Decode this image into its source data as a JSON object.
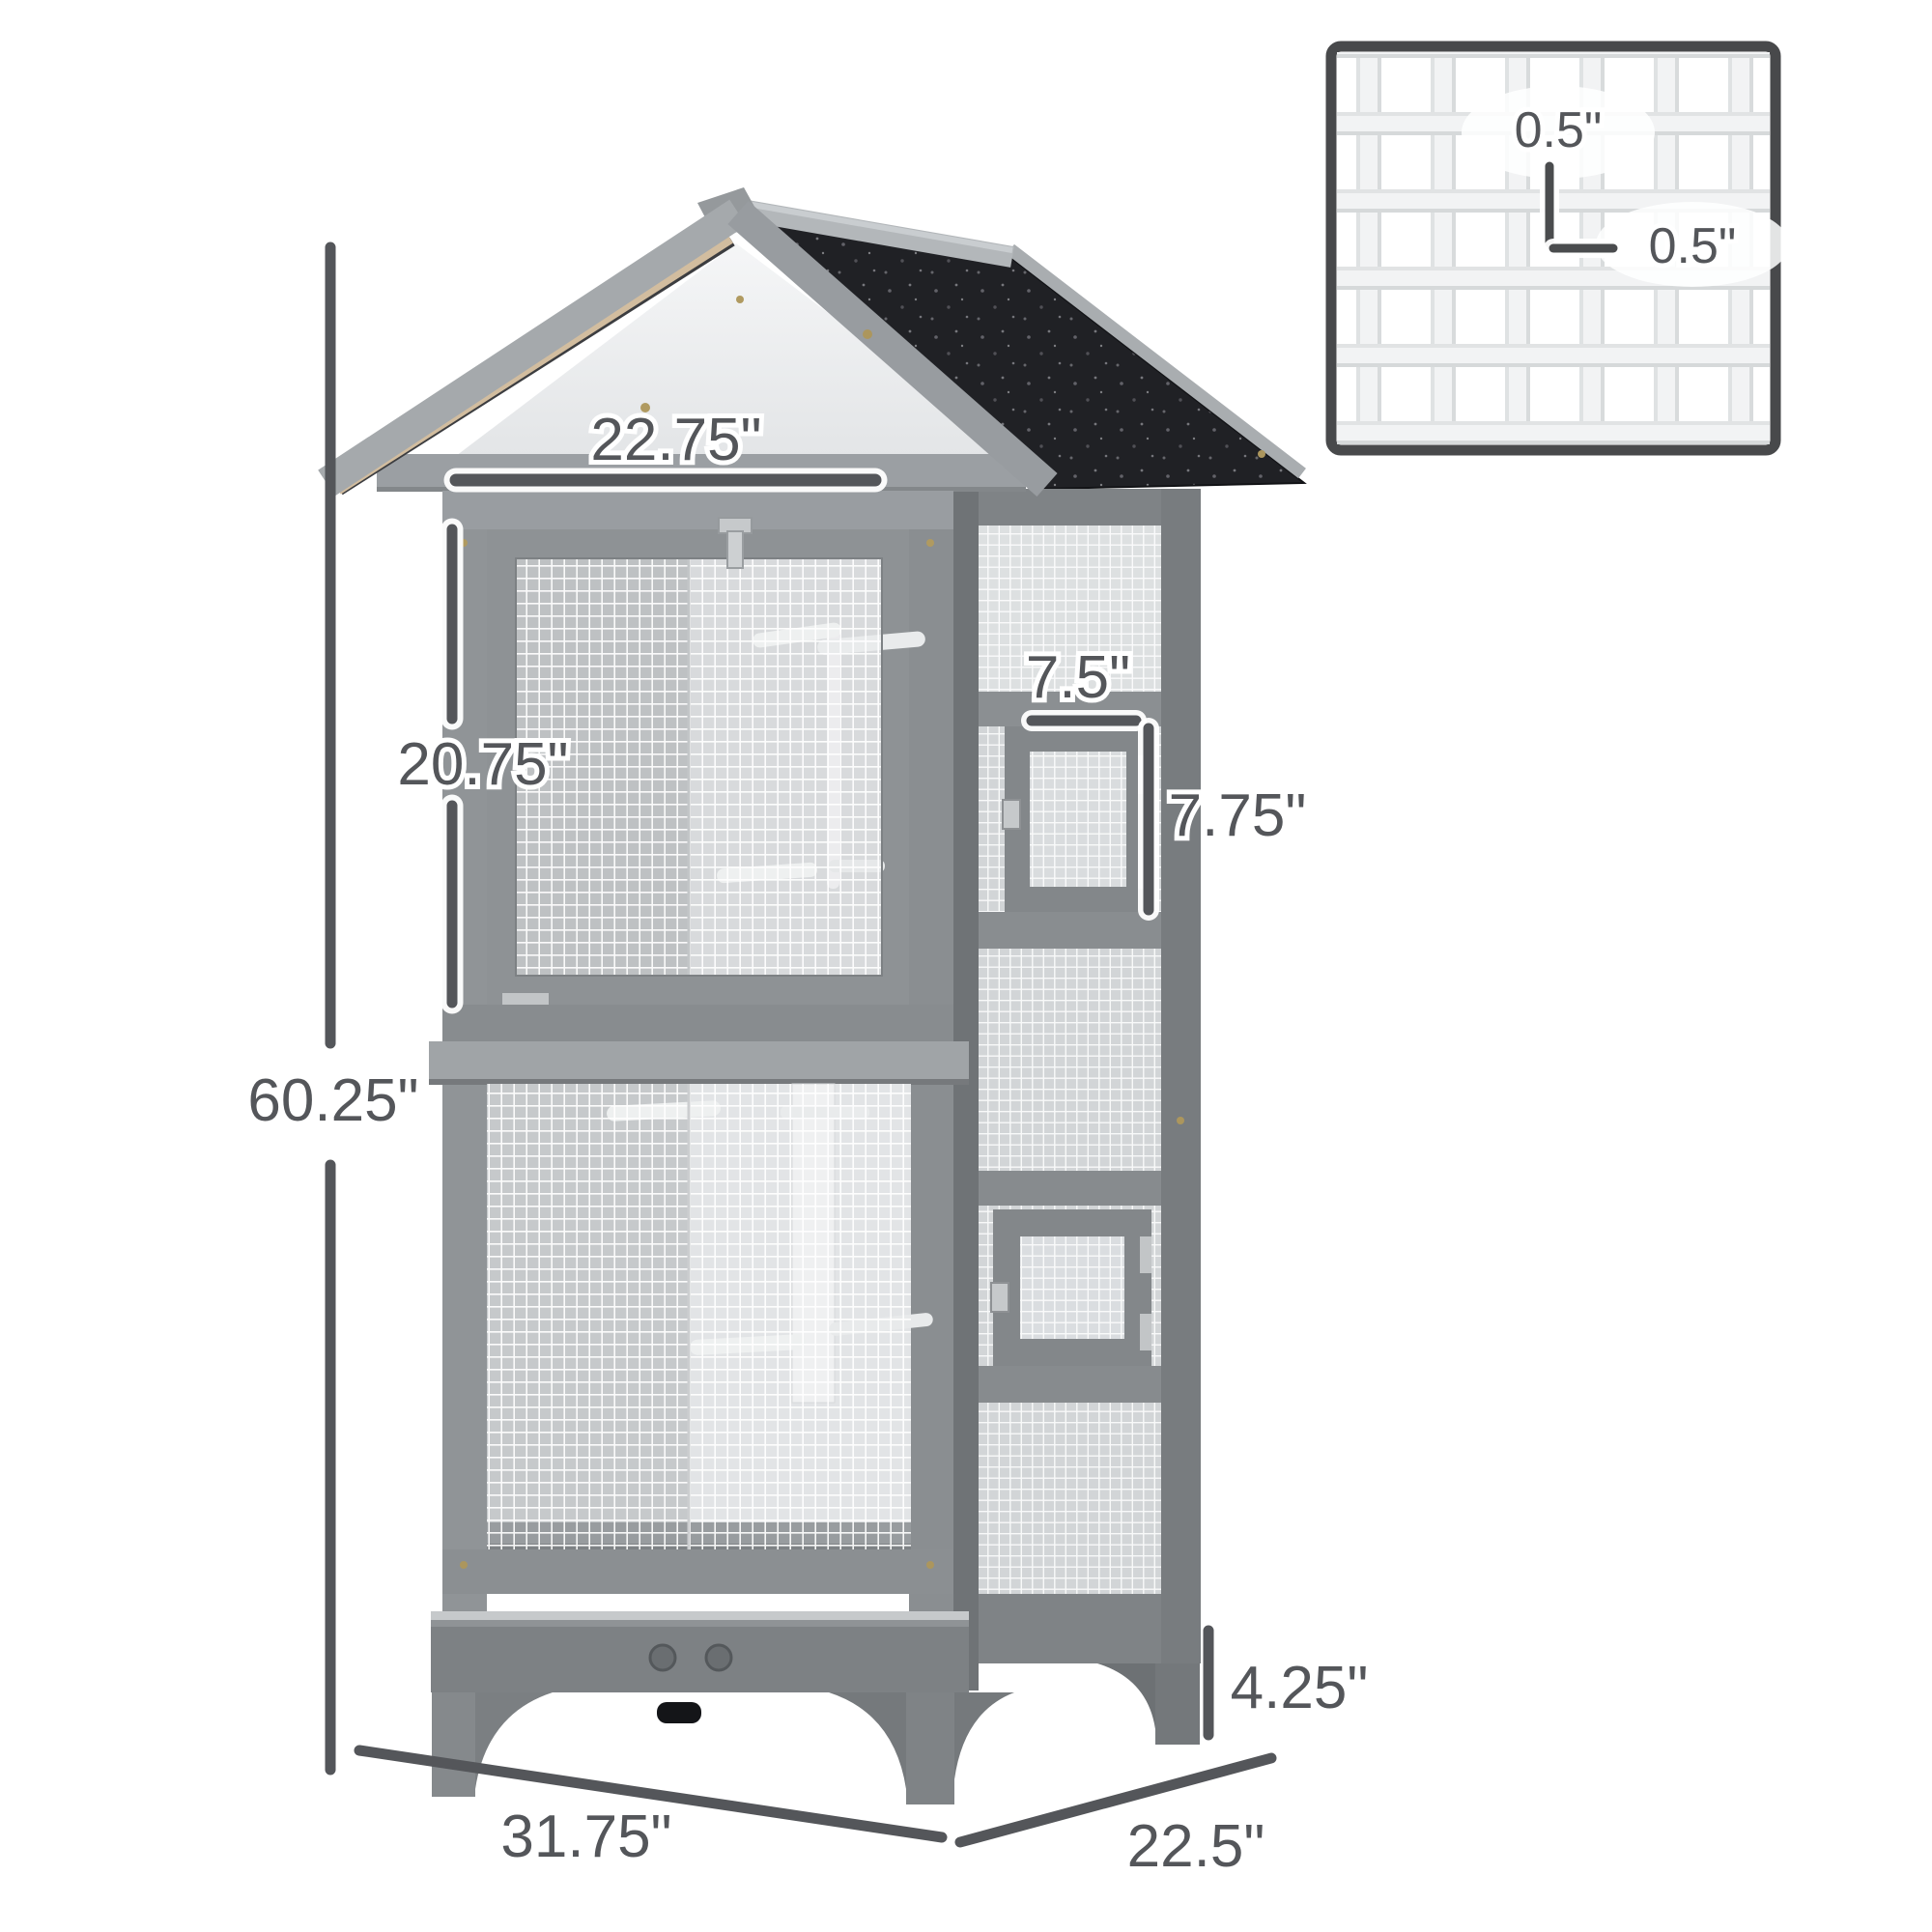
{
  "figure": {
    "type": "product-dimension-diagram",
    "background": "#ffffff"
  },
  "dimensions": {
    "front_width_top": "22.75\"",
    "upper_section_height": "20.75\"",
    "total_height": "60.25\"",
    "side_door_width": "7.5\"",
    "side_door_height": "7.75\"",
    "leg_height": "4.25\"",
    "base_width": "31.75\"",
    "base_depth": "22.5\"",
    "mesh_opening_height": "0.5\"",
    "mesh_opening_width": "0.5\""
  },
  "colors": {
    "background": "#ffffff",
    "dimension_annotation": "#54565a",
    "roof_shingle_black": "#202125",
    "roof_trim_gray": "#a5a9ac",
    "roof_underside_tan": "#d2bd9f",
    "gable_panel_white": "#eff0f2",
    "wood_frame_gray": "#8d9194",
    "mesh_wire_white": "#ffffff",
    "perch_white": "#f0f1f2",
    "hardware_silver": "#c6c9cb",
    "inset_border_gray": "#48494b"
  }
}
